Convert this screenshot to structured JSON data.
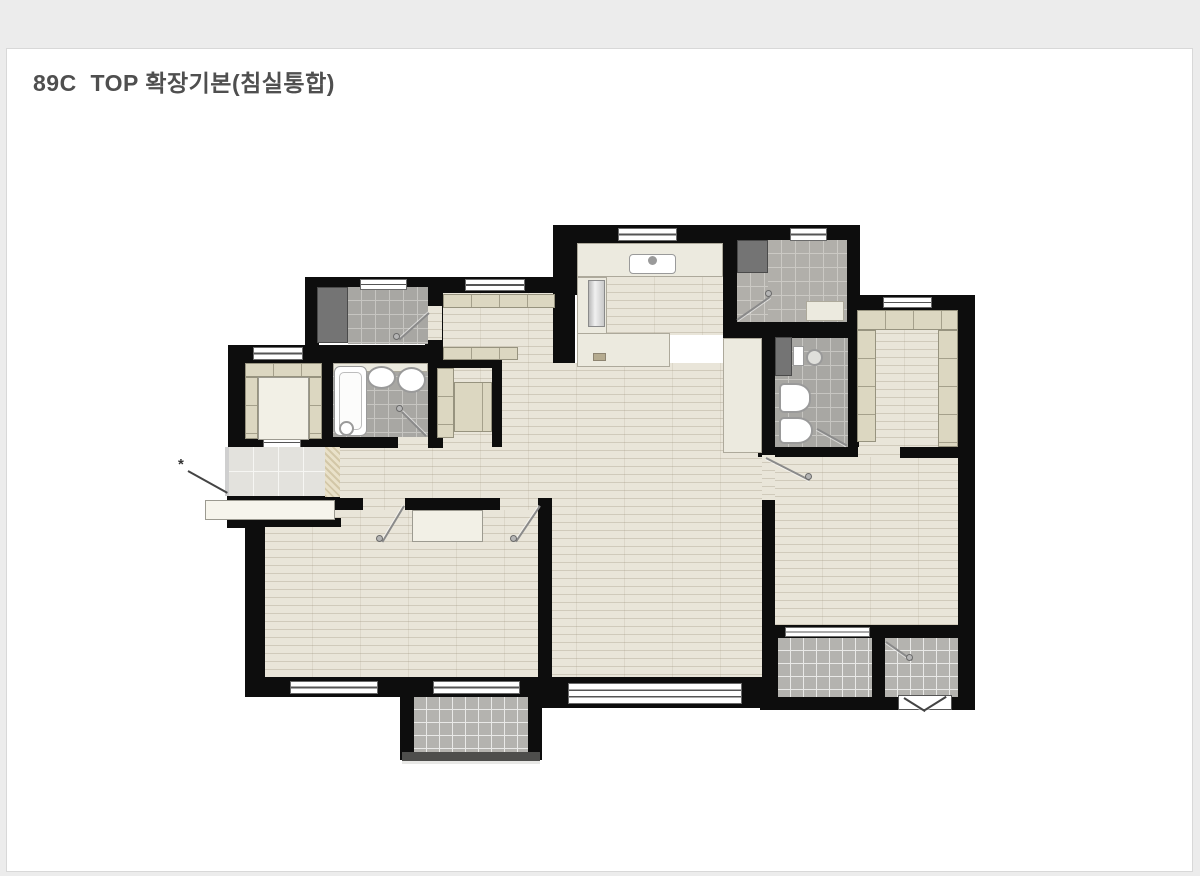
{
  "header": {
    "title": "89C  TOP 확장기본(침실통합)"
  },
  "plan": {
    "type": "floor-plan",
    "unit_label": "89C",
    "variant_label": "TOP 확장기본",
    "option_label": "침실통합",
    "colors": {
      "page_bg": "#ececec",
      "card_bg": "#ffffff",
      "card_border": "#d8d8d8",
      "title_text": "#4f4f4f",
      "wall": "#0d0d0d",
      "wood_floor": "#e9e5d9",
      "bath_tile": "#a8a7a3",
      "entry_tile": "#b1afaa",
      "balcony_tile": "#b4b3af",
      "porch_tile": "#e3e2dd",
      "wardrobe": "#dcd7c1",
      "counter": "#eceadf",
      "dark_closet": "#747474",
      "fixture_white": "#ffffff"
    },
    "markers": {
      "escape_marker": "*"
    }
  }
}
